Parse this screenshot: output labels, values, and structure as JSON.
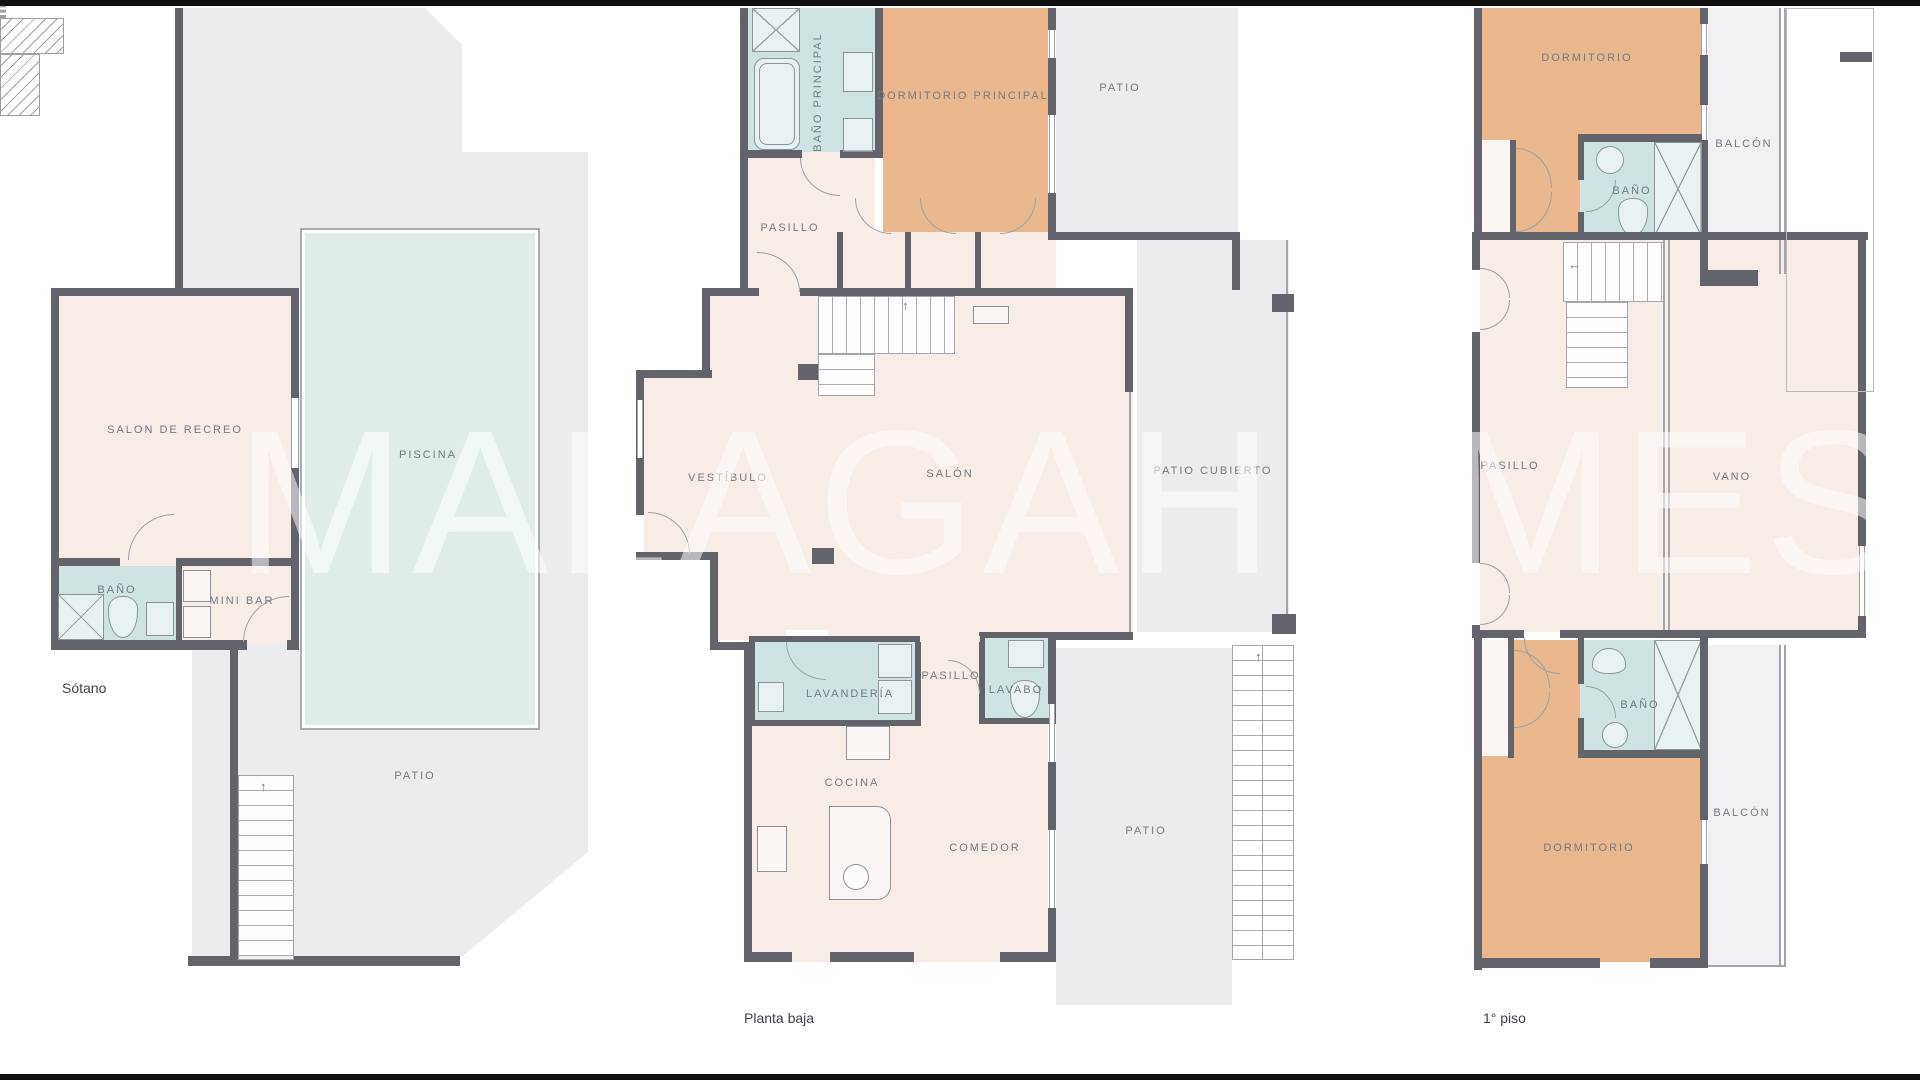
{
  "watermark": "MALAGAHOMES",
  "icons": {
    "up_arrow": "↑",
    "left_arrow": "←"
  },
  "colors": {
    "wall": "#63636b",
    "room": "#f7ece6",
    "bathroom": "#cfe3e2",
    "bedroom": "#eab88c",
    "outdoor": "#ececee",
    "pool": "#dfecea",
    "label_text": "#757b84",
    "floor_label_text": "#3d434b"
  },
  "floors": {
    "basement": {
      "name": "Sótano",
      "rooms": {
        "salon_recreo": "SALON DE RECREO",
        "piscina": "PISCINA",
        "bano": "BAÑO",
        "mini_bar": "MINI BAR",
        "patio": "PATIO"
      }
    },
    "ground": {
      "name": "Planta baja",
      "rooms": {
        "bano_principal": "BAÑO PRINCIPAL",
        "dormitorio_principal": "DORMITORIO PRINCIPAL",
        "patio_top": "PATIO",
        "pasillo": "PASILLO",
        "vestibulo": "VESTÍBULO",
        "salon": "SALÓN",
        "patio_cubierto": "PATIO CUBIERTO",
        "lavanderia": "LAVANDERÍA",
        "pasillo2": "PASILLO",
        "lavabo": "LAVABO",
        "cocina": "COCINA",
        "comedor": "COMEDOR",
        "patio_bottom": "PATIO"
      }
    },
    "first": {
      "name": "1° piso",
      "rooms": {
        "dormitorio_top": "DORMITORIO",
        "balcon_top": "BALCÓN",
        "bano_top": "BAÑO",
        "pasillo": "PASILLO",
        "vano": "VANO",
        "bano_bottom": "BAÑO",
        "balcon_bottom": "BALCÓN",
        "dormitorio_bottom": "DORMITORIO"
      }
    }
  }
}
